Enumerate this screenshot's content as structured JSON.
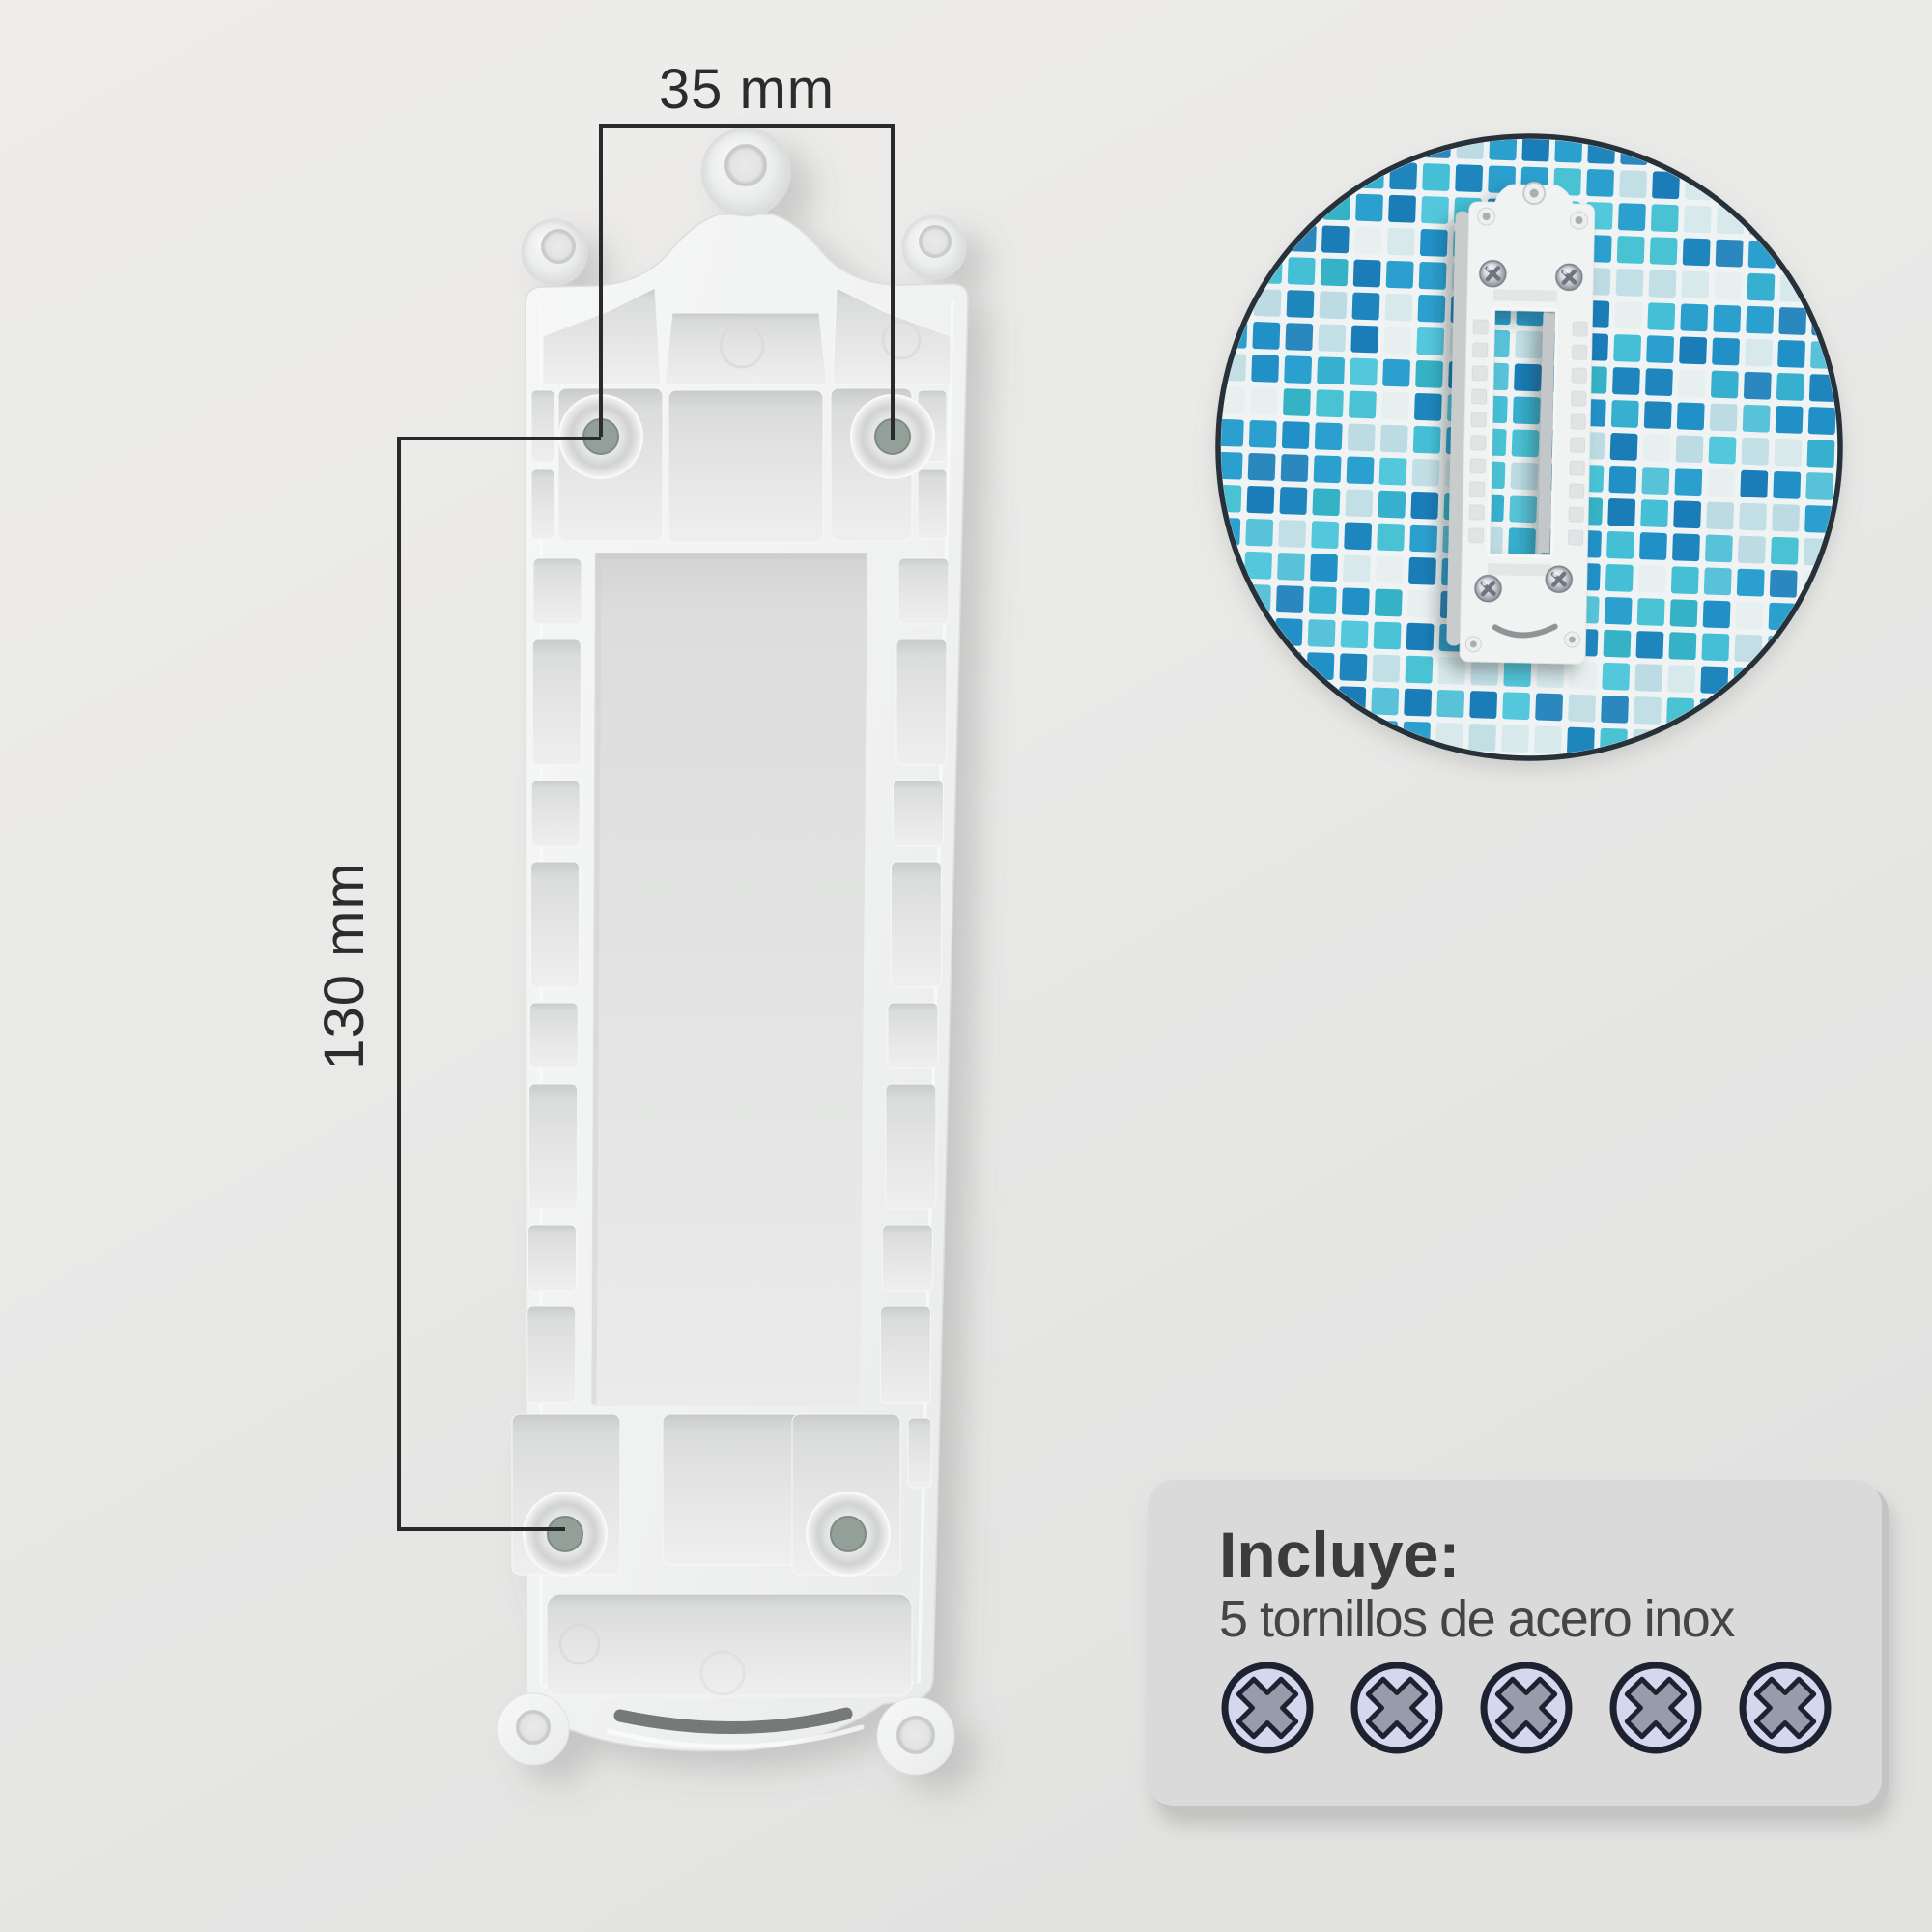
{
  "page": {
    "background_top": "#eeedeb",
    "background_bottom": "#e2e2e1"
  },
  "annotations": {
    "horizontal_dimension": "35 mm",
    "vertical_dimension": "130 mm",
    "line_color": "#2a2a2a"
  },
  "bracket": {
    "plate_color": "#f1f2f2",
    "countersunk_holes": 4,
    "hanger_holes": 3,
    "foot_holes": 2
  },
  "inset": {
    "ring_color": "#27313a",
    "grout_color": "#f0f3f3",
    "screws_visible": 4,
    "mosaic_palette": [
      "#1a7db7",
      "#2190c6",
      "#2b9fce",
      "#37afce",
      "#45bfd6",
      "#53c7dc",
      "#2a88bf",
      "#35b2c6",
      "#c3dfe6",
      "#d8e9eb",
      "#e7efef",
      "#58c3d8",
      "#1f86bd",
      "#49c2d4",
      "#bcdbe3",
      "#2b9fce"
    ]
  },
  "includes_card": {
    "title": "Incluye:",
    "subtitle": "5 tornillos de acero inox",
    "screw_count": 5,
    "background": "#dadada",
    "title_color": "#3b3b3d",
    "subtitle_color": "#454547",
    "screw_fill": "#d4d8ef",
    "screw_cross_fill": "#989baa",
    "screw_outline": "#1d2130"
  }
}
